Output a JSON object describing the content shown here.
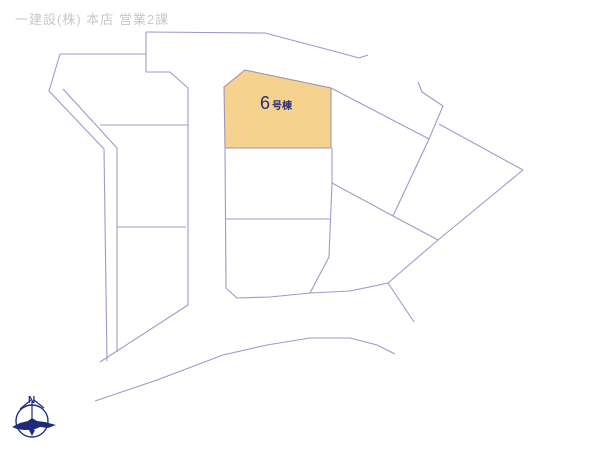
{
  "header": {
    "caption": "一建設(株) 本店 営業2課"
  },
  "parcel": {
    "number": "6",
    "suffix": "号棟",
    "full_label": "6号棟"
  },
  "compass": {
    "north_label": "N"
  },
  "colors": {
    "background": "#ffffff",
    "line": "#999cc9",
    "highlight_fill": "#f6d28f",
    "highlight_stroke": "#a394ad",
    "header_text": "#c8c8c8",
    "parcel_text": "#2b2e6e",
    "compass": "#1e2b7b"
  },
  "map": {
    "highlight": {
      "name": "parcel-6-shape",
      "points": [
        [
          245,
          70
        ],
        [
          331,
          88
        ],
        [
          331,
          148
        ],
        [
          225,
          148
        ],
        [
          224,
          87
        ]
      ]
    },
    "lines": [
      {
        "name": "road-top-edge",
        "points": [
          [
            146,
            32
          ],
          [
            265,
            33
          ],
          [
            337,
            52
          ],
          [
            359,
            58
          ],
          [
            368,
            55
          ]
        ]
      },
      {
        "name": "road-west-edge",
        "points": [
          [
            146,
            32
          ],
          [
            146,
            72
          ],
          [
            170,
            72
          ],
          [
            188,
            88
          ],
          [
            188,
            305
          ],
          [
            100,
            362
          ]
        ]
      },
      {
        "name": "block-left-top",
        "points": [
          [
            60,
            54
          ],
          [
            146,
            54
          ]
        ]
      },
      {
        "name": "strip-outer-edge",
        "points": [
          [
            60,
            54
          ],
          [
            49,
            91
          ],
          [
            104,
            149
          ],
          [
            107,
            361
          ]
        ]
      },
      {
        "name": "strip-inner-edge",
        "points": [
          [
            63,
            89
          ],
          [
            117,
            148
          ],
          [
            117,
            352
          ]
        ]
      },
      {
        "name": "block-left-divider-upper",
        "points": [
          [
            100,
            125
          ],
          [
            188,
            125
          ]
        ]
      },
      {
        "name": "block-left-divider-lower",
        "points": [
          [
            117,
            227
          ],
          [
            186,
            227
          ]
        ]
      },
      {
        "name": "diag-parcel6-to-j1",
        "points": [
          [
            331,
            88
          ],
          [
            429,
            139
          ]
        ]
      },
      {
        "name": "midcol-left-and-bottom",
        "points": [
          [
            225,
            148
          ],
          [
            226,
            288
          ],
          [
            237,
            298
          ],
          [
            270,
            297
          ],
          [
            310,
            293
          ],
          [
            350,
            291
          ],
          [
            388,
            283
          ]
        ]
      },
      {
        "name": "midcol-right-edge",
        "points": [
          [
            332,
            148
          ],
          [
            332,
            183
          ],
          [
            329,
            257
          ],
          [
            310,
            293
          ]
        ]
      },
      {
        "name": "midcol-divider",
        "points": [
          [
            226,
            219
          ],
          [
            330,
            219
          ]
        ]
      },
      {
        "name": "branch-to-j2",
        "points": [
          [
            332,
            183
          ],
          [
            393,
            216
          ]
        ]
      },
      {
        "name": "rotated-parcel-left-edge",
        "points": [
          [
            429,
            139
          ],
          [
            393,
            216
          ]
        ]
      },
      {
        "name": "j2-to-j4",
        "points": [
          [
            393,
            216
          ],
          [
            438,
            240
          ]
        ]
      },
      {
        "name": "road-kink-east",
        "points": [
          [
            418,
            82
          ],
          [
            422,
            92
          ],
          [
            443,
            106
          ],
          [
            429,
            139
          ]
        ]
      },
      {
        "name": "diag-to-east-corner",
        "points": [
          [
            439,
            124
          ],
          [
            523,
            170
          ]
        ]
      },
      {
        "name": "east-corner-down",
        "points": [
          [
            523,
            170
          ],
          [
            438,
            240
          ]
        ]
      },
      {
        "name": "j4-to-j5",
        "points": [
          [
            438,
            240
          ],
          [
            388,
            283
          ]
        ]
      },
      {
        "name": "stub-southeast",
        "points": [
          [
            388,
            283
          ],
          [
            414,
            322
          ]
        ]
      },
      {
        "name": "road-bottom-curve",
        "points": [
          [
            95,
            401
          ],
          [
            157,
            380
          ],
          [
            223,
            355
          ],
          [
            267,
            345
          ],
          [
            310,
            338
          ],
          [
            350,
            338
          ],
          [
            377,
            345
          ],
          [
            395,
            354
          ]
        ]
      }
    ]
  }
}
